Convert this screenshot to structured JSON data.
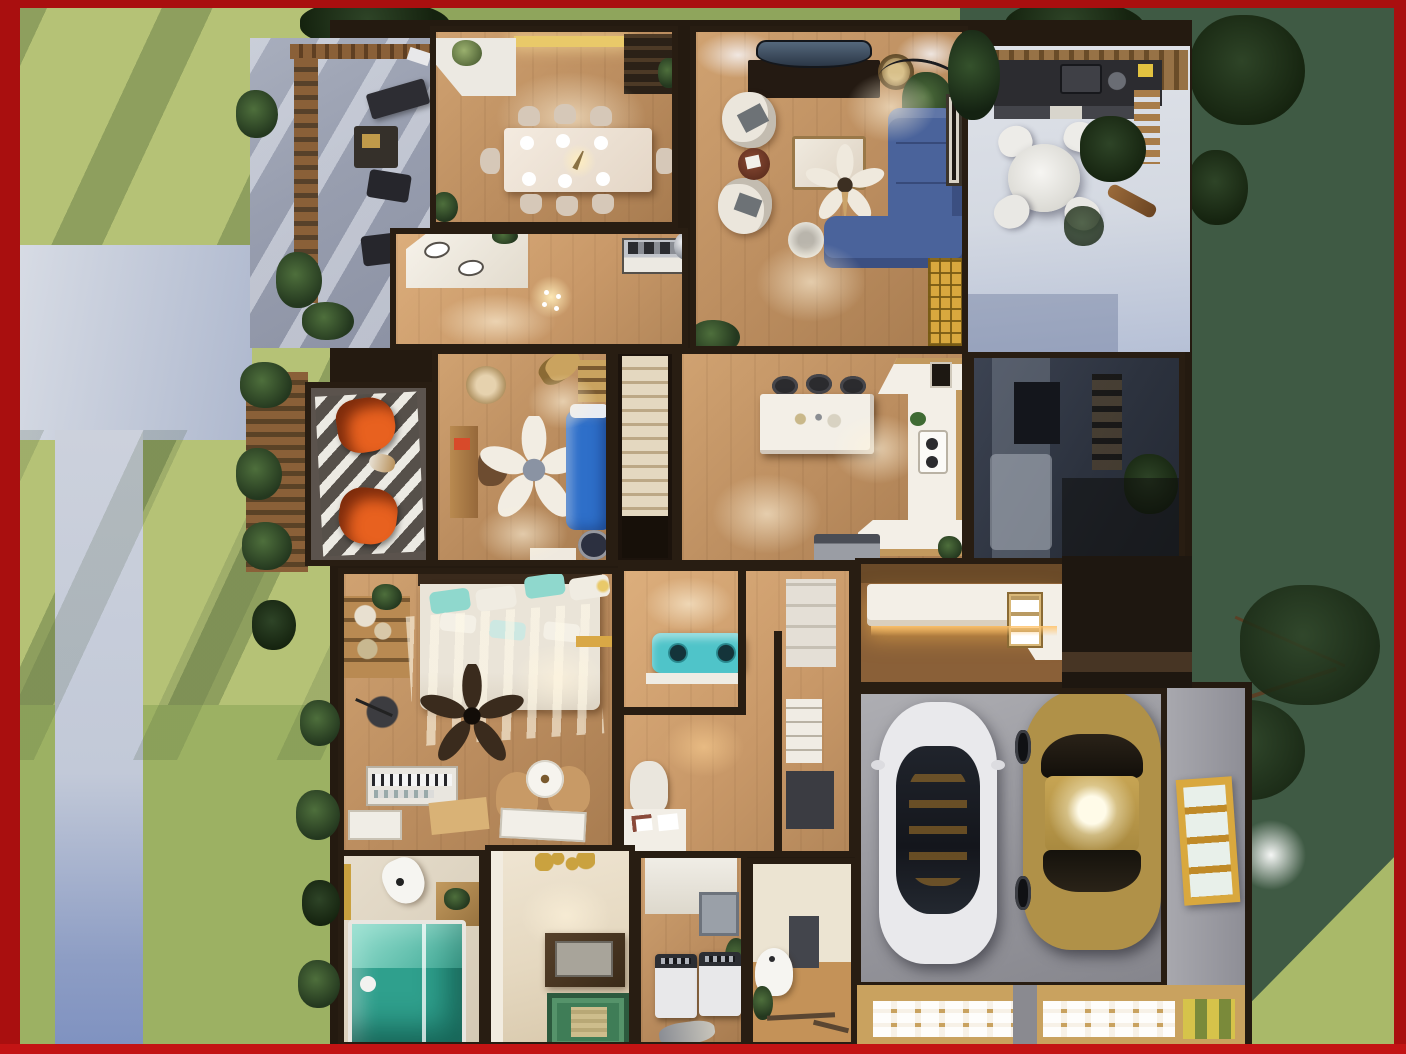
{
  "scene": {
    "description": "Photorealistic top-down 3D floor plan render of a single-story house with front porch, side deck, covered patio, rear yard and attached two-car garage, framed by a dark red border",
    "render_type": "3d-floorplan-top-view",
    "rooms": [
      {
        "id": "dining-room",
        "furniture": [
          "dining-table",
          "eight-dining-chairs",
          "chandelier",
          "china-cabinet",
          "corner-console-with-flowers",
          "lit-windows"
        ]
      },
      {
        "id": "living-room",
        "furniture": [
          "curved-tv",
          "media-console",
          "blue-sectional-sofa",
          "two-round-armchairs",
          "round-side-table",
          "coffee-table",
          "ceiling-fan",
          "arc-floor-lamp",
          "rattan-pendant",
          "potted-plant",
          "wall-art",
          "gold-mullion-window",
          "round-stool"
        ]
      },
      {
        "id": "foyer-hall",
        "furniture": [
          "vanity-counter-with-sinks",
          "range-cooker",
          "small-chandelier",
          "mirror-vase-pedestal"
        ]
      },
      {
        "id": "den-office",
        "furniture": [
          "white-ceiling-fan",
          "blue-daybed",
          "writing-desk",
          "desk-chair",
          "guitar",
          "ladder-shelf",
          "wicker-chair",
          "patterned-pouf",
          "low-cabinet"
        ]
      },
      {
        "id": "kitchen",
        "furniture": [
          "island",
          "three-bar-stools",
          "wrap-around-counter",
          "double-sink",
          "refrigerator",
          "wall-art",
          "planter"
        ]
      },
      {
        "id": "staircase",
        "furniture": [
          "wood-stairs"
        ]
      },
      {
        "id": "shaded-bedroom",
        "furniture": [
          "bed",
          "dark-dresser",
          "ladder-shelf"
        ]
      },
      {
        "id": "master-bedroom",
        "furniture": [
          "bed-with-teal-pillows",
          "dark-ceiling-fan",
          "keyboard-piano",
          "two-accent-chairs",
          "round-motif-table",
          "storage-shelf",
          "floor-lamp",
          "yellow-wall-shelf"
        ]
      },
      {
        "id": "hallway-closets",
        "furniture": [
          "teal-retro-bench",
          "white-wardrobe",
          "drawer-unit",
          "dark-dresser",
          "kids-desk",
          "white-desk-chair"
        ]
      },
      {
        "id": "mudroom",
        "furniture": [
          "l-shaped-lit-bench",
          "cubby-organizer"
        ]
      },
      {
        "id": "garage",
        "furniture": [
          "white-sedan",
          "gold-sedan",
          "yellow-frame-window",
          "paver-aprons"
        ]
      },
      {
        "id": "bathroom",
        "furniture": [
          "toilet",
          "teal-glass-shower",
          "wood-vanity"
        ]
      },
      {
        "id": "entry-room",
        "furniture": [
          "sputnik-ceiling-light",
          "dark-console-table",
          "green-patterned-rug"
        ]
      },
      {
        "id": "laundry-room",
        "furniture": [
          "washer",
          "dryer",
          "wall-board",
          "planter"
        ]
      },
      {
        "id": "guest-bath",
        "furniture": [
          "pedestal-sink",
          "gray-cabinet",
          "towel-bar",
          "planter"
        ]
      }
    ],
    "outdoor_areas": [
      {
        "id": "front-porch",
        "features": [
          "pergola",
          "outdoor-bench",
          "two-outdoor-chairs",
          "side-table",
          "planters"
        ]
      },
      {
        "id": "side-deck",
        "features": [
          "striped-rug",
          "two-orange-butterfly-chairs",
          "small-dog",
          "pergola-with-plants"
        ]
      },
      {
        "id": "covered-patio",
        "features": [
          "outdoor-kitchen-grill",
          "white-round-table",
          "four-white-chairs",
          "pergola-lattice",
          "large-planter",
          "leaning-tree-trunk"
        ]
      },
      {
        "id": "left-yard",
        "features": [
          "sunlit-grass",
          "tree-shadows",
          "driveway",
          "walkway",
          "shrubs"
        ]
      },
      {
        "id": "rear-yard",
        "features": [
          "dark-grass",
          "tree-canopy",
          "tree-branches",
          "wall-lantern",
          "light-grass-corner"
        ]
      }
    ],
    "vehicles": [
      "white-sedan",
      "gold-sedan"
    ]
  },
  "colors": {
    "frame_red": "#a90f0f",
    "frame_red_bright": "#c31414",
    "grass_sunlit": "#b5c276",
    "grass_bottom": "#9cb163",
    "grass_dark": "#3f5a44",
    "grass_corner_light": "#a9b969",
    "driveway_concrete": "#c6cdda",
    "walkway_concrete": "#c9cedb",
    "porch_concrete": "#9ba1b1",
    "patio_concrete": "#dcdfe6",
    "wall_dark": "#281d12",
    "wood_floor": "#bb8d5f",
    "deck_wood": "#5b534d",
    "sofa_blue": "#4a639b",
    "daybed_blue": "#2e6fc9",
    "butterfly_chair_orange": "#e8611f",
    "teal_shower": "#2fa08d",
    "teal_bench": "#4fc4c9",
    "teal_pillow": "#8fd8cd",
    "car_white": "#e9e9ec",
    "car_gold": "#b09148",
    "window_yellow": "#d9a83e",
    "counter_white": "#f3efe7",
    "cabinet_wood": "#c2995e",
    "garage_floor": "#9c9ca2",
    "garage_apron": "#c9a25f"
  }
}
